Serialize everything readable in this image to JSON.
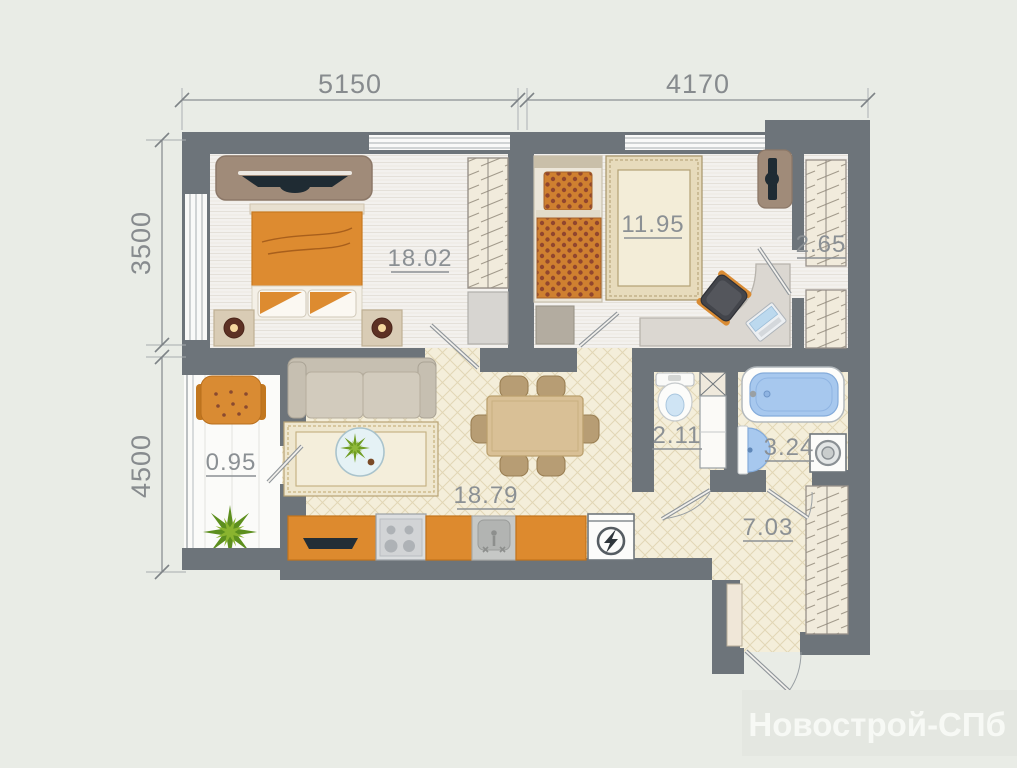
{
  "watermark": "Новострой-СПб",
  "dimensions": {
    "top": [
      "5150",
      "4170"
    ],
    "left": [
      "3500",
      "4500"
    ]
  },
  "rooms": {
    "bedroom": {
      "area": "18.02"
    },
    "kids_room": {
      "area": "11.95"
    },
    "closet": {
      "area": "2.65"
    },
    "balcony": {
      "area": "0.95"
    },
    "living_kitchen": {
      "area": "18.79"
    },
    "wc": {
      "area": "2.11"
    },
    "bathroom": {
      "area": "3.24"
    },
    "hallway": {
      "area": "7.03"
    }
  },
  "colors": {
    "wall": "#6d747a",
    "accent_orange": "#d98a33",
    "water_blue": "#a7c8ee",
    "label_gray": "#8b9094",
    "background": "#e9ece6"
  }
}
